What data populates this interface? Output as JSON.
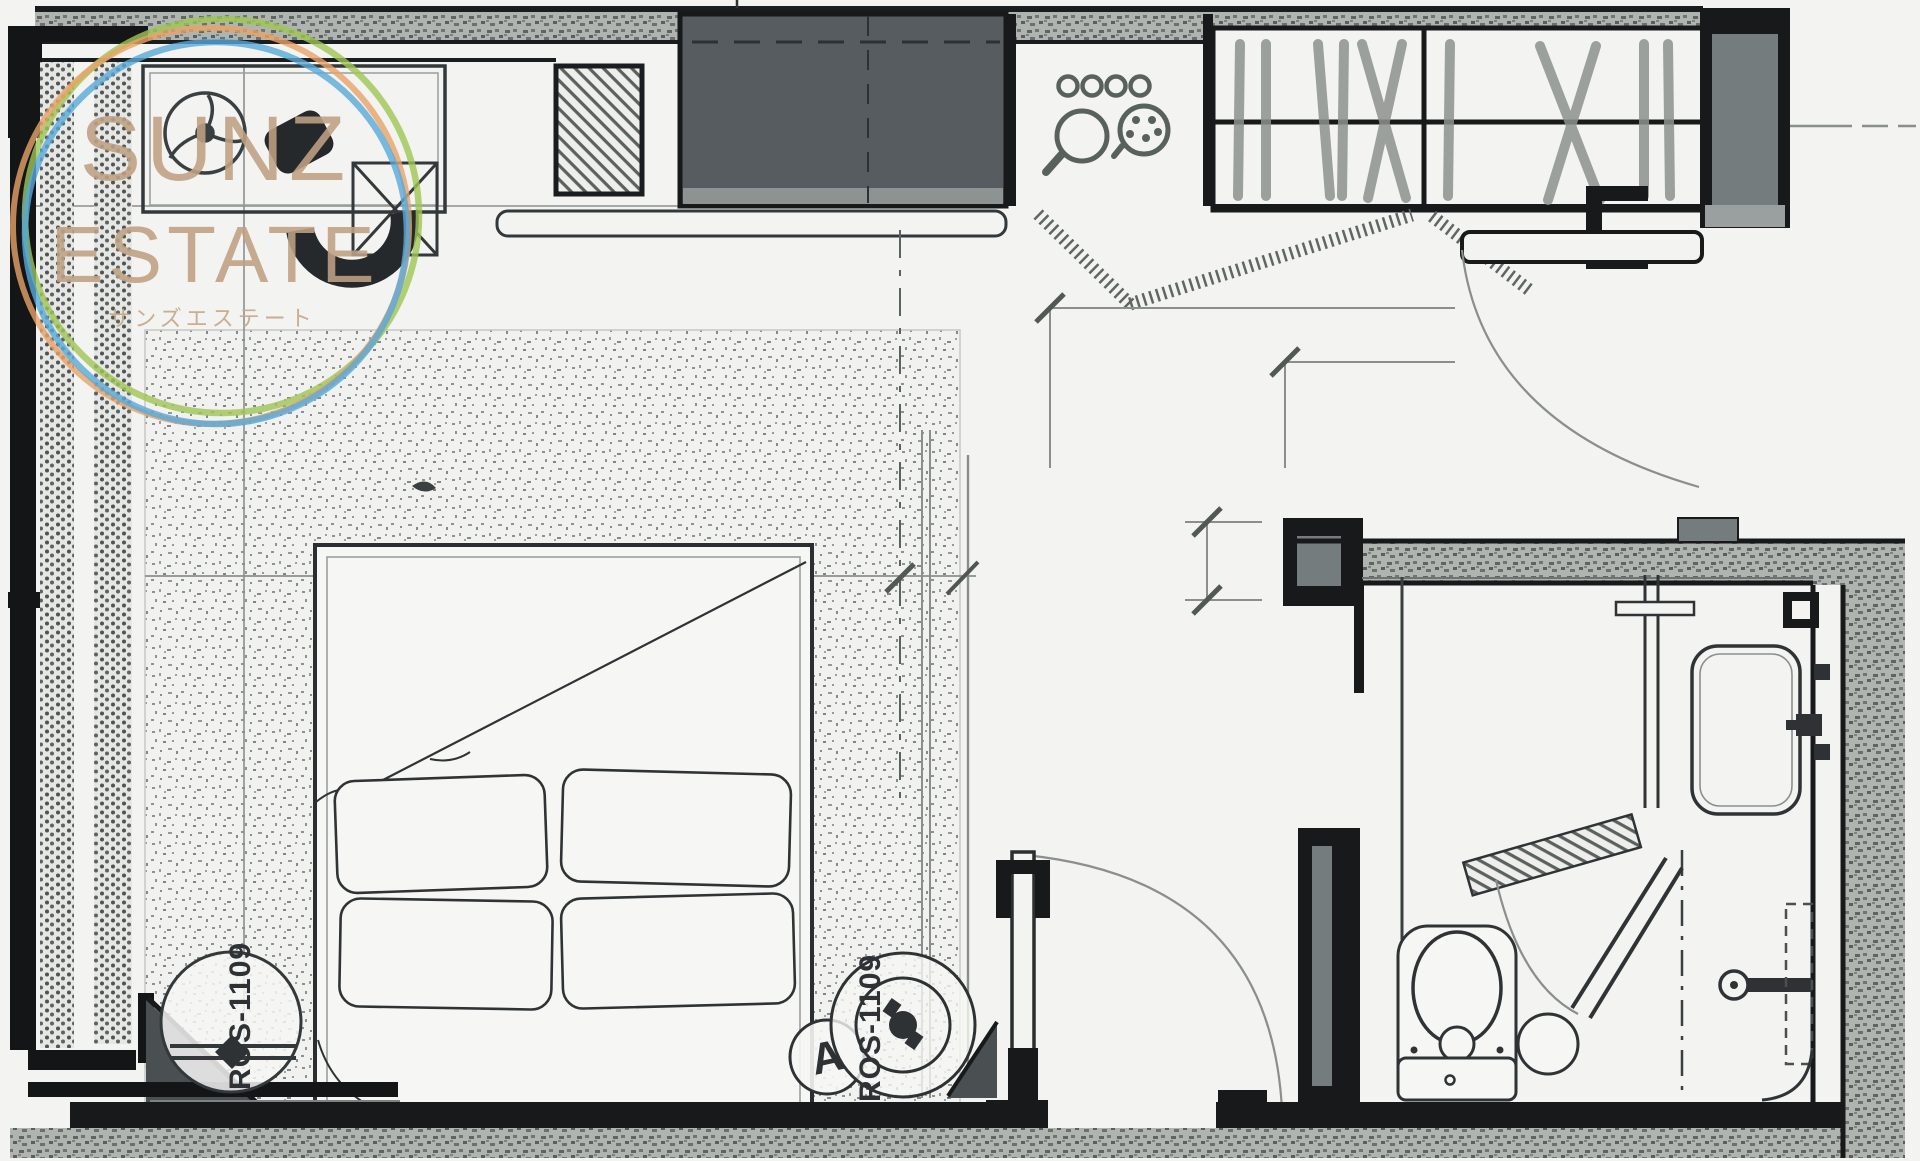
{
  "watermark": {
    "line1": "SUNZ",
    "line2": "ESTATE",
    "subtitle": "サンズエステート"
  },
  "annotations": {
    "sprinkler_label_left": "ROS-1109",
    "sprinkler_label_right": "ROS-1109",
    "detail_marker": "A"
  },
  "palette": {
    "paper": "#f3f3f1",
    "wall_dark": "#17191b",
    "wall_speckle": "#b0b4b0",
    "cabinet_dark": "#565c5f",
    "line_gray": "#8a8f8e",
    "watermark_text": "#bfa183",
    "ring_green": "#9fc654",
    "ring_orange": "#e8a266",
    "ring_blue": "#58a9da"
  }
}
